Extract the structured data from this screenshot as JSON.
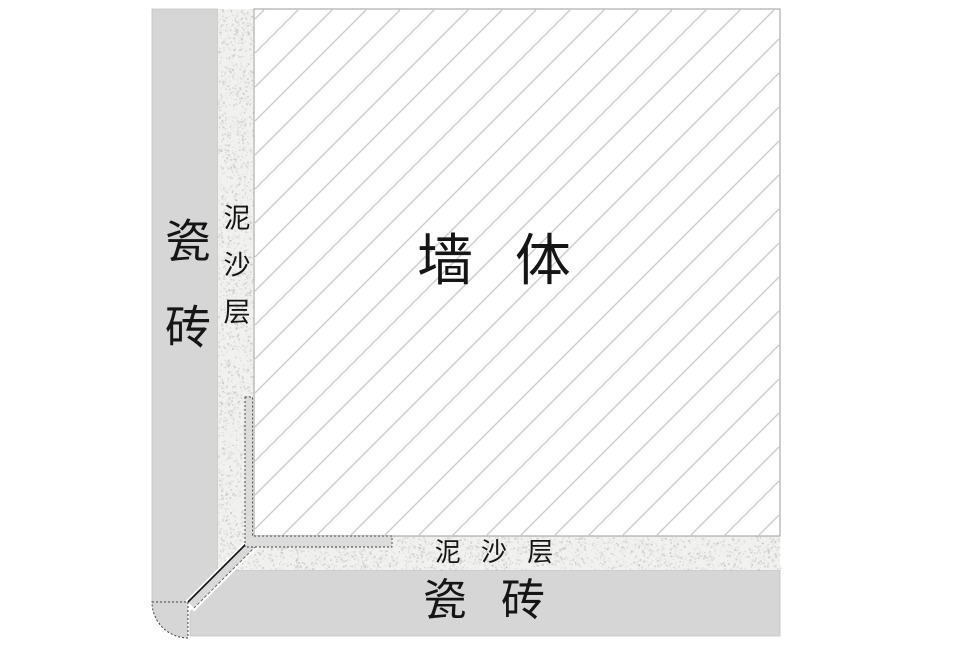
{
  "diagram": {
    "type": "wall-tile-installation-cross-section",
    "labels": {
      "wall": "墙 体",
      "tile_left": "瓷砖",
      "mortar_left": "泥沙层",
      "mortar_bottom": "泥 沙 层",
      "tile_bottom": "瓷 砖"
    },
    "colors": {
      "background": "#ffffff",
      "tile": "#d6d6d6",
      "tile_edge": "#c2c2c2",
      "mortar_base": "#f1f1ef",
      "speckle": "#b9b9b9",
      "wall_fill": "#ffffff",
      "wall_border": "#9b9b9b",
      "hatch": "#cccccc",
      "trim_fill": "#dcdcdc",
      "trim_border": "#3f3f3f",
      "band_fill": "#d9d9d9",
      "band_edge_dark": "#161616",
      "band_edge_light": "#6a6a6a",
      "text": "#151515"
    }
  }
}
